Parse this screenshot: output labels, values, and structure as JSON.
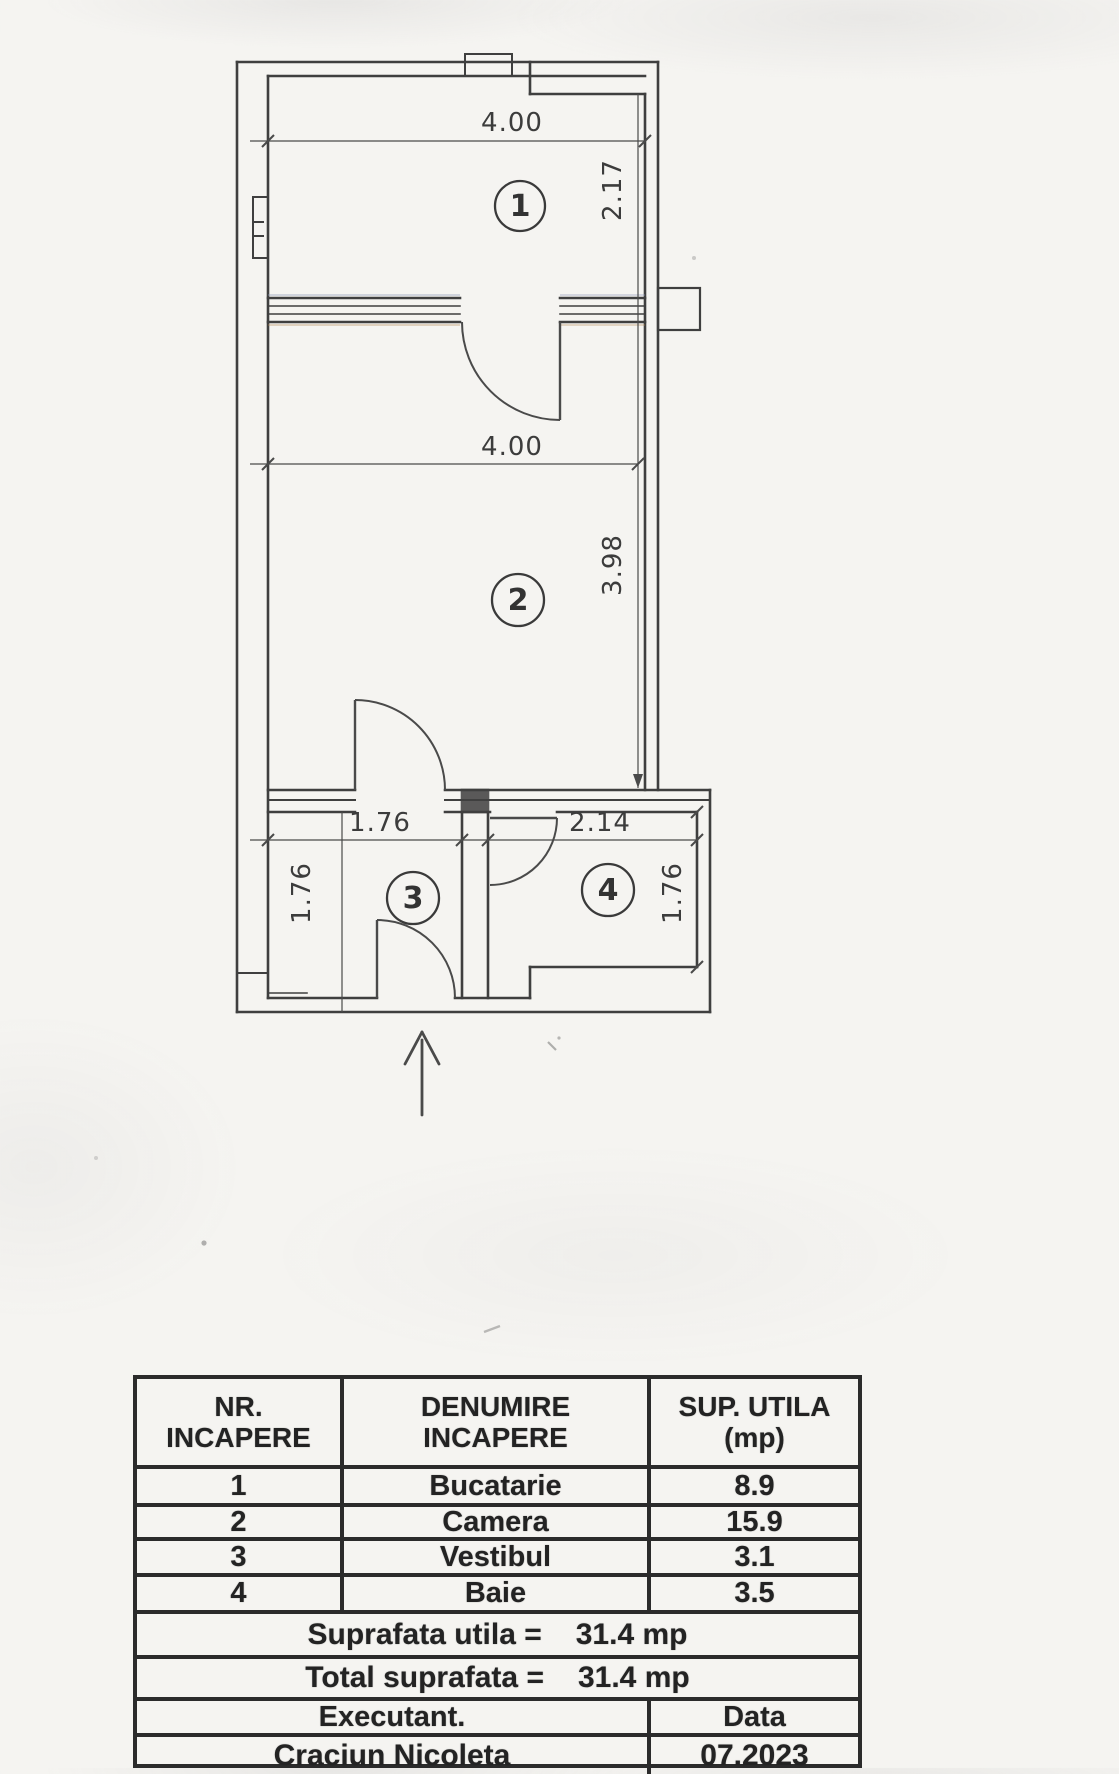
{
  "plan": {
    "room_labels": [
      "1",
      "2",
      "3",
      "4"
    ],
    "dims": {
      "room1_width": "4.00",
      "room1_height": "2.17",
      "room2_width": "4.00",
      "room2_height": "3.98",
      "room3_width": "1.76",
      "room3_height": "1.76",
      "room4_width": "2.14",
      "room4_height": "1.76"
    }
  },
  "table": {
    "headers": [
      [
        "NR.",
        "INCAPERE"
      ],
      [
        "DENUMIRE",
        "INCAPERE"
      ],
      [
        "SUP. UTILA",
        "(mp)"
      ]
    ],
    "rows": [
      [
        "1",
        "Bucatarie",
        "8.9"
      ],
      [
        "2",
        "Camera",
        "15.9"
      ],
      [
        "3",
        "Vestibul",
        "3.1"
      ],
      [
        "4",
        "Baie",
        "3.5"
      ]
    ],
    "totals": [
      {
        "label": "Suprafata utila =",
        "value": "31.4 mp"
      },
      {
        "label": "Total suprafata =",
        "value": "31.4 mp"
      }
    ],
    "executant_label": "Executant.",
    "date_label": "Data",
    "executant_name": "Craciun Nicoleta",
    "date_value": "07.2023"
  }
}
